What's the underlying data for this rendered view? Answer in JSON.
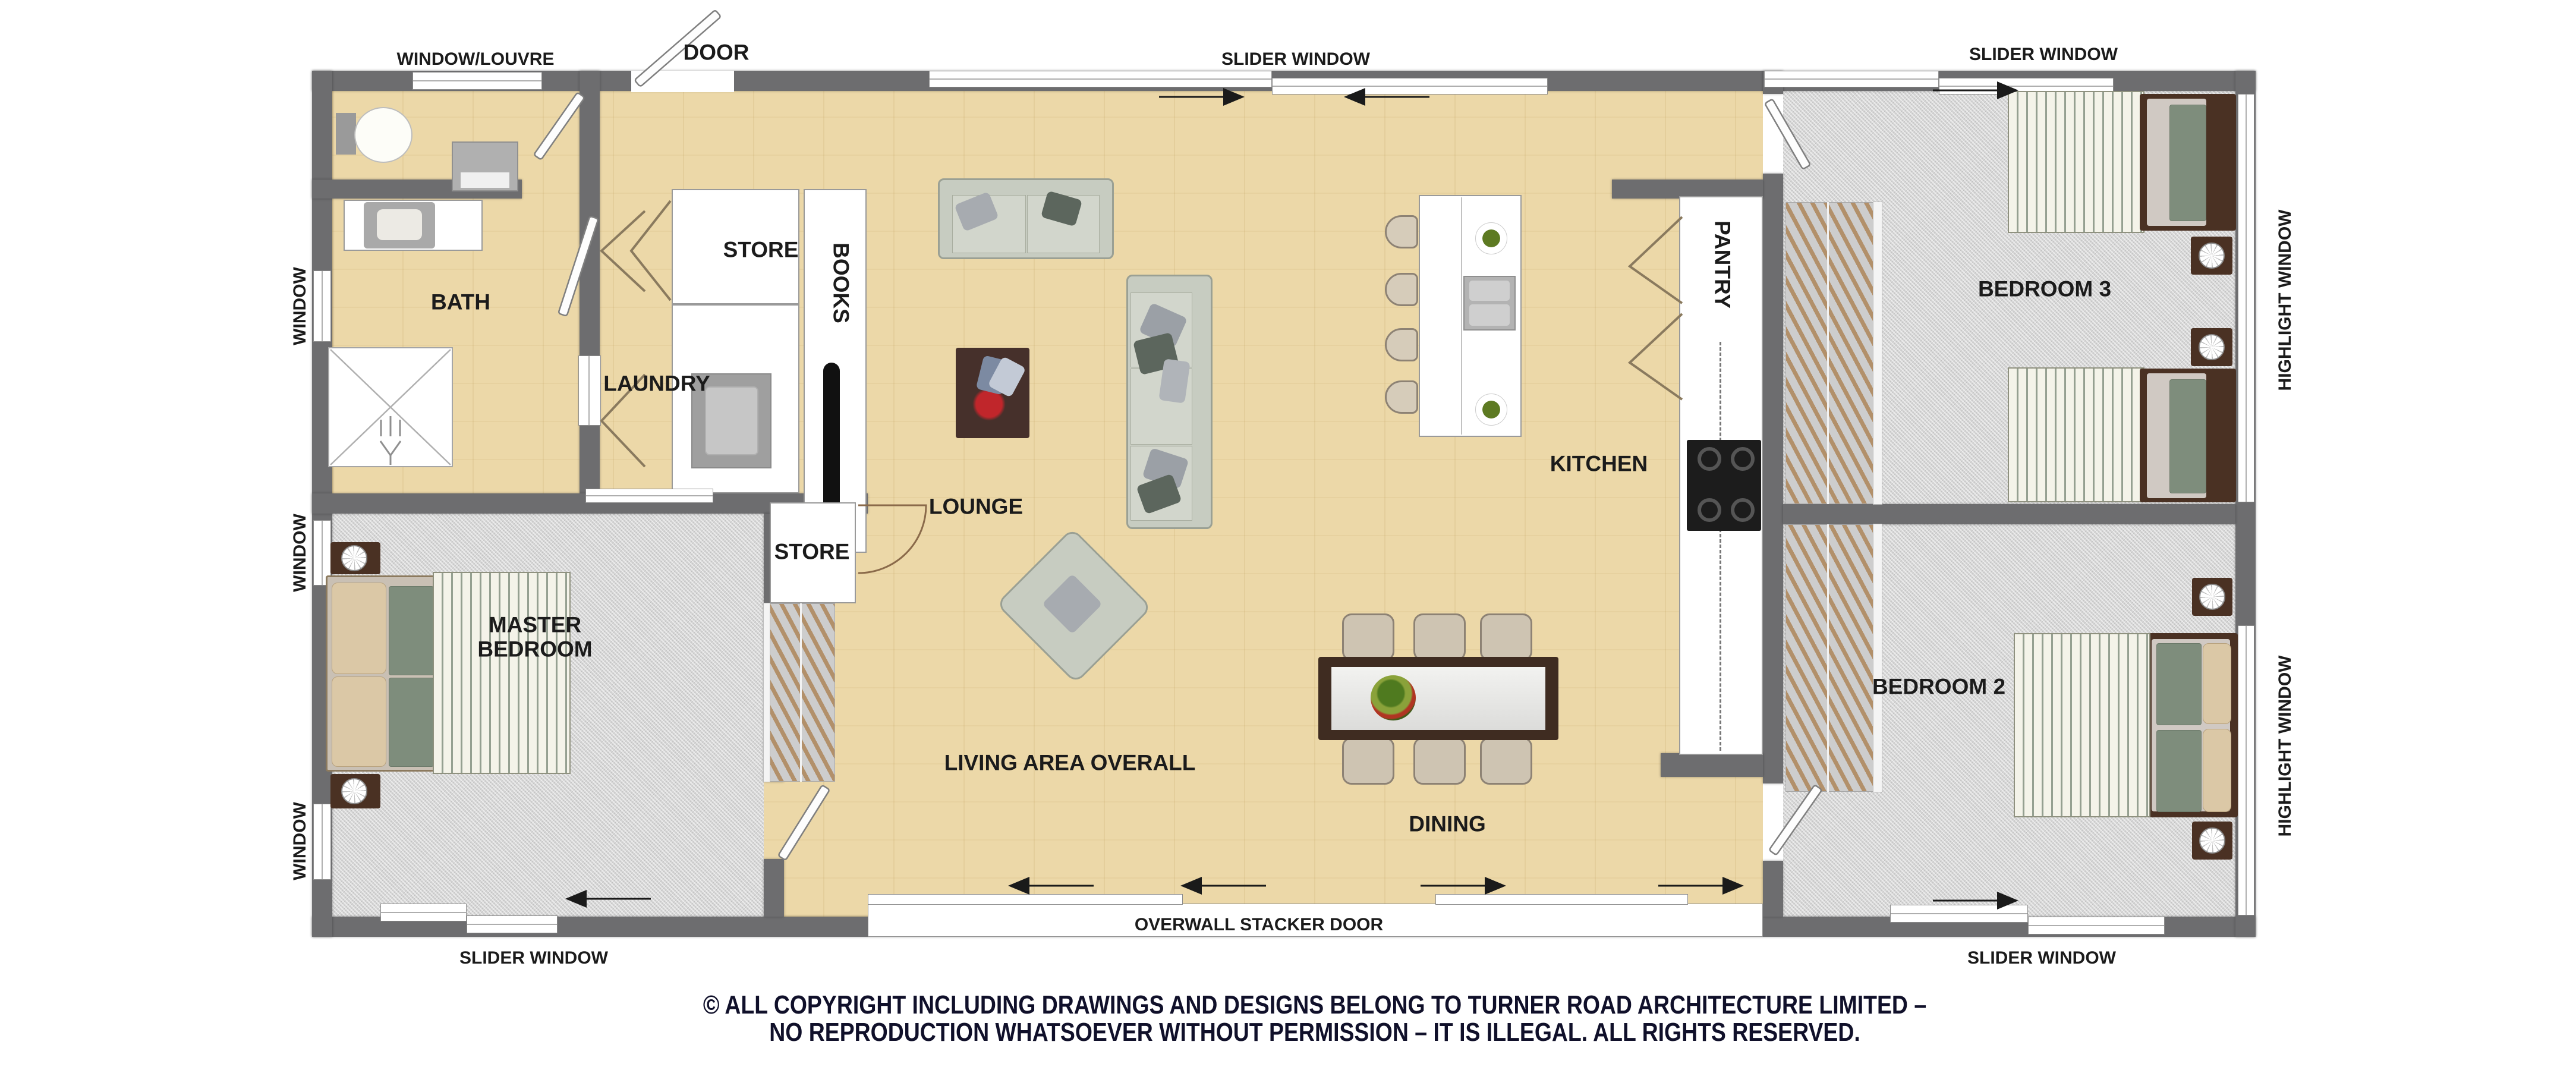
{
  "colors": {
    "wall": "#6d6d6f",
    "wood_floor": "#ecd8a8",
    "carpet_floor": "#d6d6d6",
    "label_text": "#1b1b1b",
    "copyright_text": "#10102a",
    "bed_green": "#7e8d7c",
    "dark_wood": "#4a3123"
  },
  "rooms": {
    "bath": "BATH",
    "laundry": "LAUNDRY",
    "store_upper": "STORE",
    "store_lower": "STORE",
    "books": "BOOKS",
    "lounge": "LOUNGE",
    "pantry": "PANTRY",
    "kitchen": "KITCHEN",
    "bedroom3": "BEDROOM 3",
    "bedroom2": "BEDROOM 2",
    "master_line1": "MASTER",
    "master_line2": "BEDROOM",
    "living": "LIVING AREA OVERALL",
    "dining": "DINING"
  },
  "openings": {
    "window_louvre": "WINDOW/LOUVRE",
    "door": "DOOR",
    "slider_window": "SLIDER WINDOW",
    "highlight_window": "HIGHLIGHT WINDOW",
    "window": "WINDOW",
    "stacker_door": "OVERWALL STACKER DOOR"
  },
  "footer": {
    "line1": "© ALL COPYRIGHT INCLUDING DRAWINGS AND DESIGNS BELONG TO TURNER ROAD ARCHITECTURE LIMITED –",
    "line2": "NO REPRODUCTION WHATSOEVER WITHOUT PERMISSION – IT IS ILLEGAL. ALL RIGHTS RESERVED."
  }
}
